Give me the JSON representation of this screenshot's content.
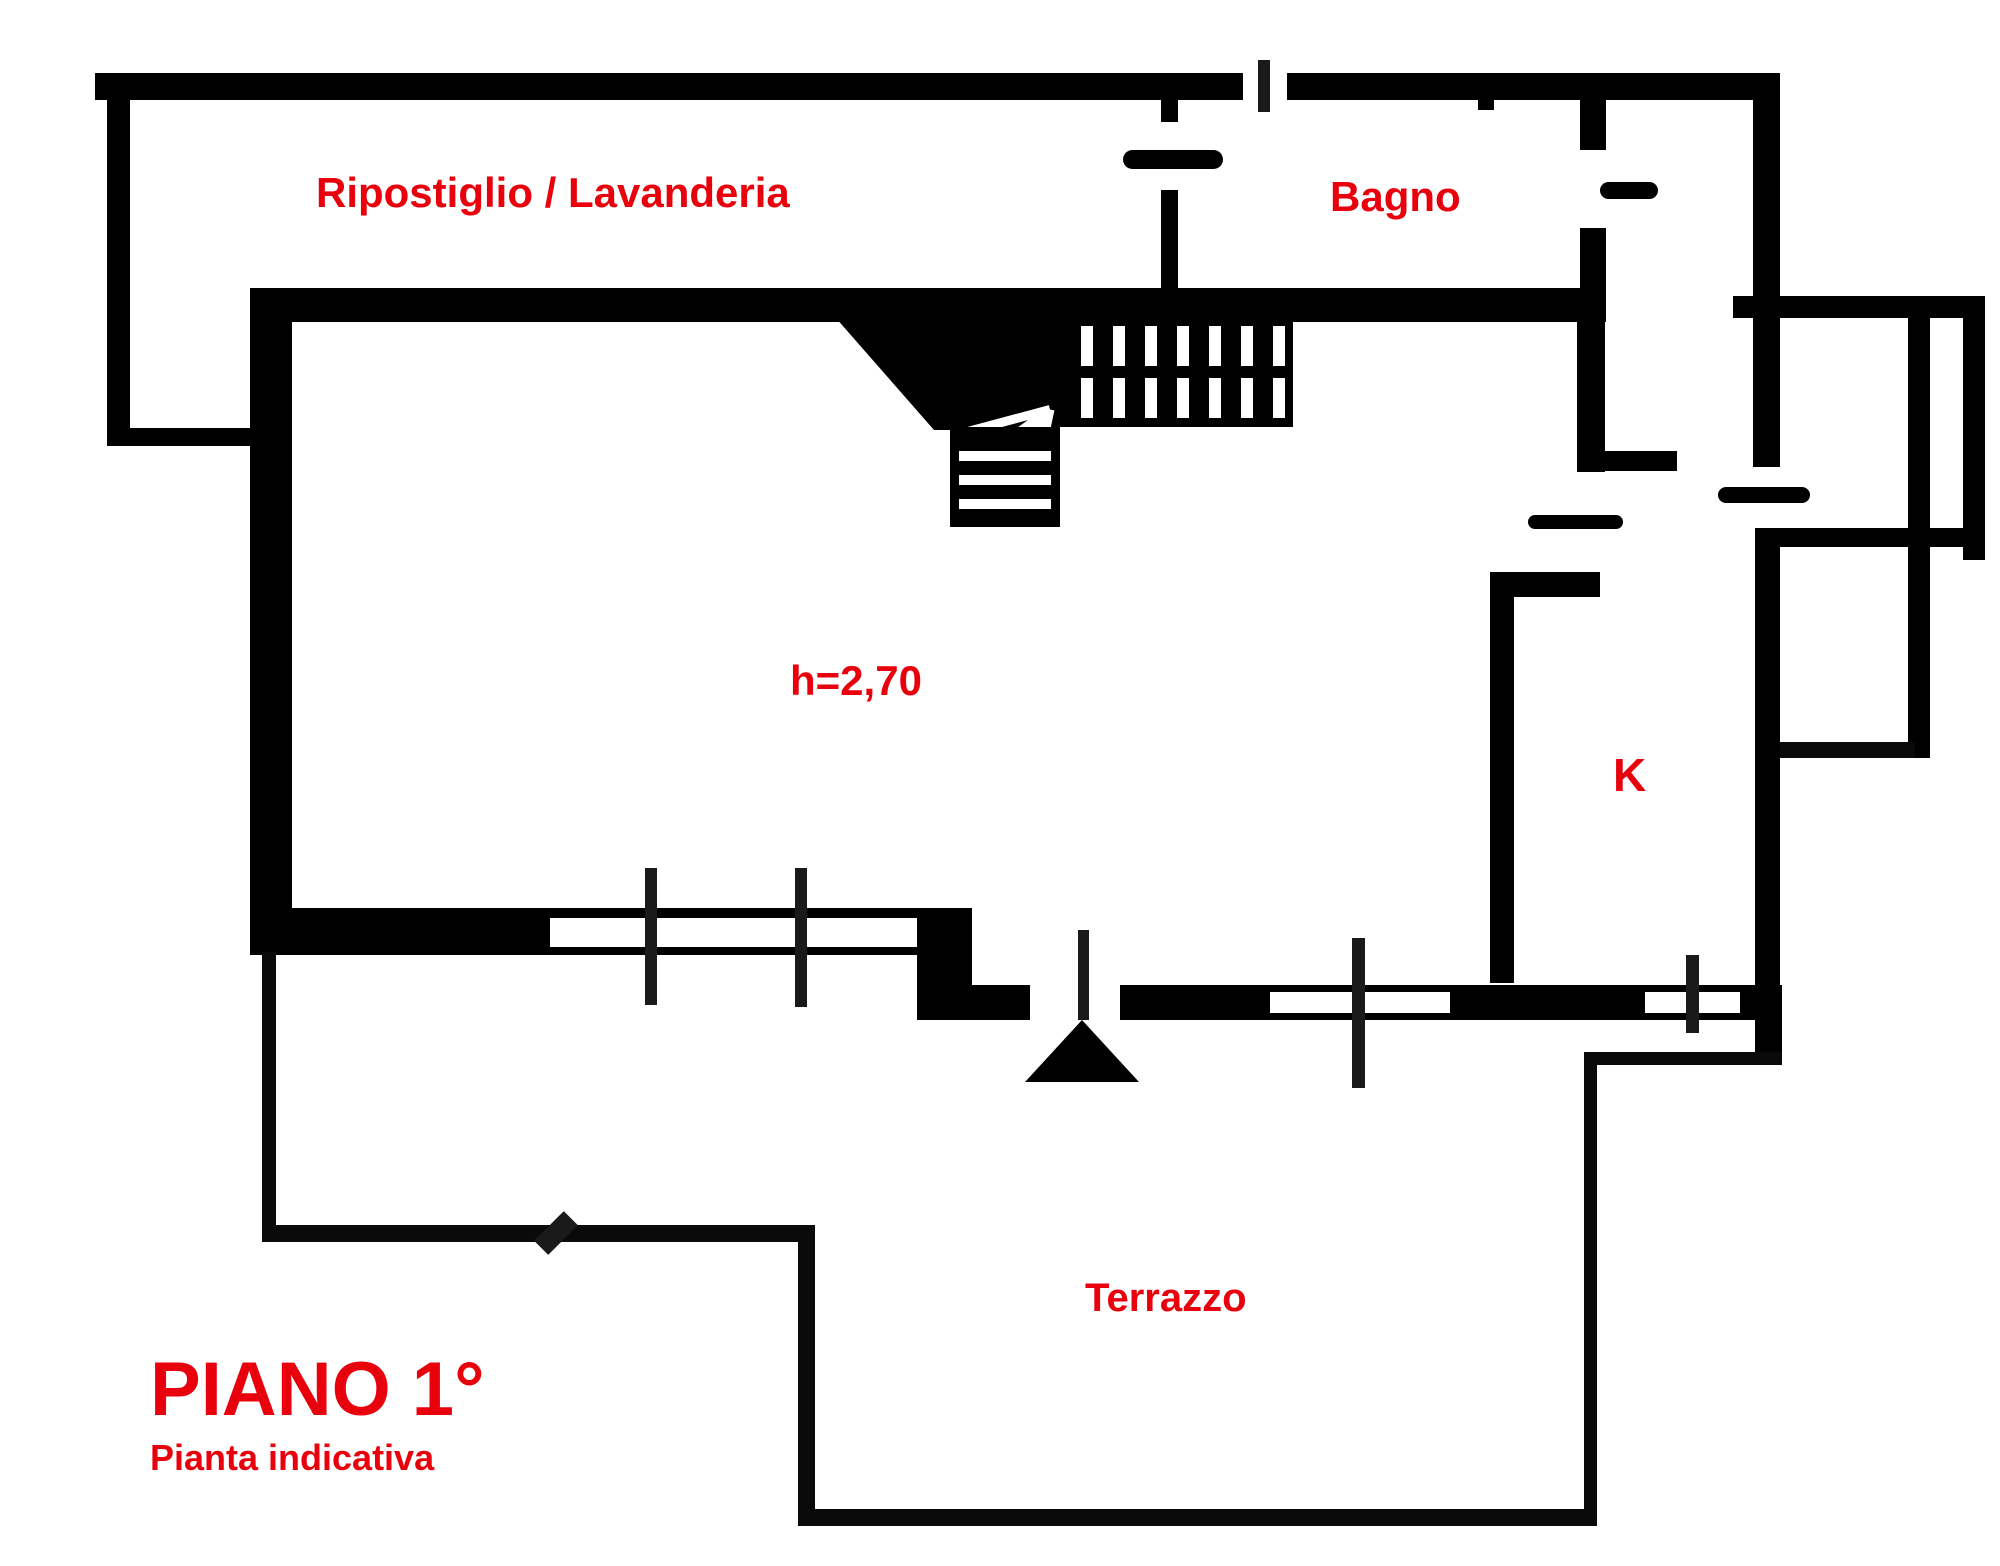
{
  "title": {
    "floor": "PIANO 1°",
    "subtitle": "Pianta indicativa"
  },
  "rooms": [
    {
      "id": "ripostiglio-lavanderia",
      "label": "Ripostiglio / Lavanderia"
    },
    {
      "id": "bagno",
      "label": "Bagno"
    },
    {
      "id": "living",
      "label": "h=2,70"
    },
    {
      "id": "kitchen",
      "label": "K"
    },
    {
      "id": "terrazzo",
      "label": "Terrazzo"
    }
  ],
  "colors": {
    "label": "#e8000d",
    "walls": "#000000",
    "background": "#ffffff"
  }
}
